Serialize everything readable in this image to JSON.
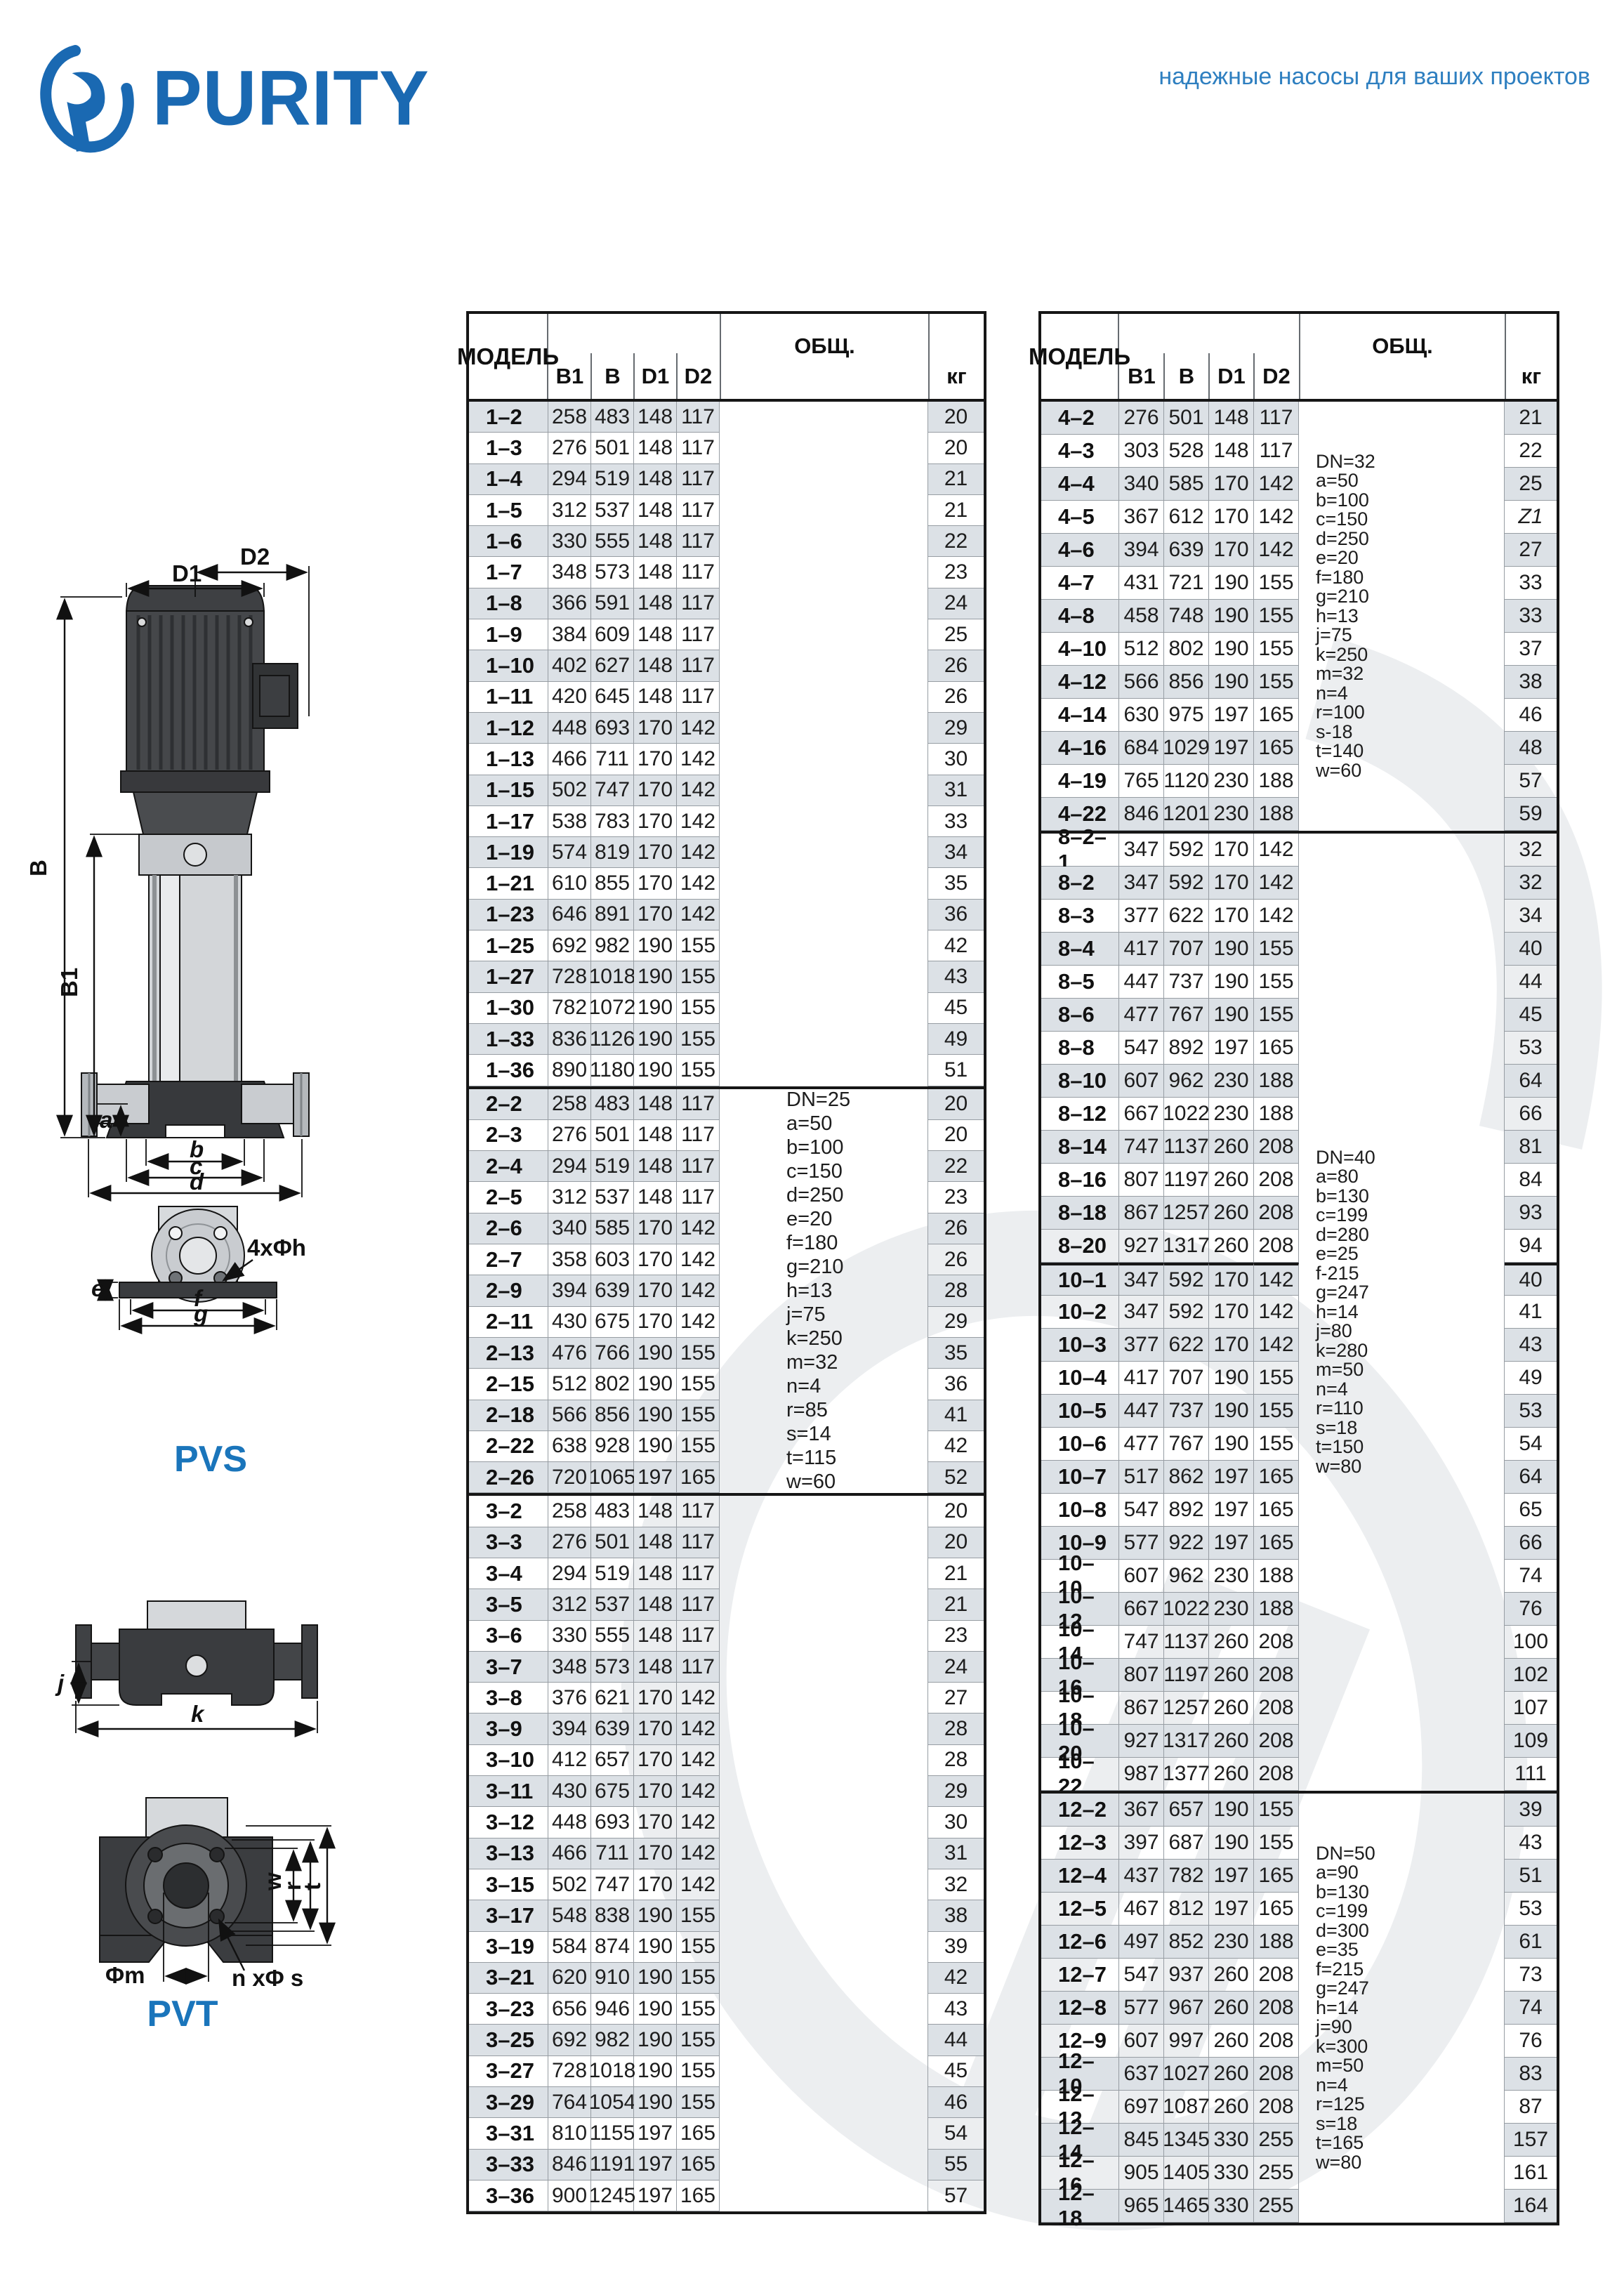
{
  "header": {
    "brand": "PURITY",
    "tagline": "надежные насосы для ваших проектов",
    "brand_color": "#1a69b2",
    "tagline_color": "#2e7fc0"
  },
  "diagrams": {
    "pvs_title": "PVS",
    "pvt_title": "PVT",
    "pvs_dims": [
      "D2",
      "D1",
      "B",
      "B1",
      "a",
      "b",
      "c",
      "d",
      "e",
      "f",
      "g",
      "4xΦh"
    ],
    "jk_dims": [
      "j",
      "k"
    ],
    "pvt_dims": [
      "Φm",
      "n xΦ s",
      "w",
      "r",
      "t"
    ],
    "title_color": "#1a75bb"
  },
  "tables": [
    {
      "id": "table-left",
      "headers": {
        "model": "МОДЕЛЬ",
        "b1": "B1",
        "b": "B",
        "d1": "D1",
        "d2": "D2",
        "obsh": "ОБЩ.",
        "kg": "кг"
      },
      "sections": [
        {
          "notes": [],
          "rows": [
            [
              "1–2",
              258,
              483,
              148,
              117,
              20
            ],
            [
              "1–3",
              276,
              501,
              148,
              117,
              20
            ],
            [
              "1–4",
              294,
              519,
              148,
              117,
              21
            ],
            [
              "1–5",
              312,
              537,
              148,
              117,
              21
            ],
            [
              "1–6",
              330,
              555,
              148,
              117,
              22
            ],
            [
              "1–7",
              348,
              573,
              148,
              117,
              23
            ],
            [
              "1–8",
              366,
              591,
              148,
              117,
              24
            ],
            [
              "1–9",
              384,
              609,
              148,
              117,
              25
            ],
            [
              "1–10",
              402,
              627,
              148,
              117,
              26
            ],
            [
              "1–11",
              420,
              645,
              148,
              117,
              26
            ],
            [
              "1–12",
              448,
              693,
              170,
              142,
              29
            ],
            [
              "1–13",
              466,
              711,
              170,
              142,
              30
            ],
            [
              "1–15",
              502,
              747,
              170,
              142,
              31
            ],
            [
              "1–17",
              538,
              783,
              170,
              142,
              33
            ],
            [
              "1–19",
              574,
              819,
              170,
              142,
              34
            ],
            [
              "1–21",
              610,
              855,
              170,
              142,
              35
            ],
            [
              "1–23",
              646,
              891,
              170,
              142,
              36
            ],
            [
              "1–25",
              692,
              982,
              190,
              155,
              42
            ],
            [
              "1–27",
              728,
              1018,
              190,
              155,
              43
            ],
            [
              "1–30",
              782,
              1072,
              190,
              155,
              45
            ],
            [
              "1–33",
              836,
              1126,
              190,
              155,
              49
            ],
            [
              "1–36",
              890,
              1180,
              190,
              155,
              51
            ]
          ]
        },
        {
          "notes": [
            "DN=25",
            "a=50",
            "b=100",
            "c=150",
            "d=250",
            "e=20",
            "f=180",
            "g=210",
            "h=13",
            "j=75",
            "k=250",
            "m=32",
            "n=4",
            "r=85",
            "s=14",
            "t=115",
            "w=60"
          ],
          "rows": [
            [
              "2–2",
              258,
              483,
              148,
              117,
              20
            ],
            [
              "2–3",
              276,
              501,
              148,
              117,
              20
            ],
            [
              "2–4",
              294,
              519,
              148,
              117,
              22
            ],
            [
              "2–5",
              312,
              537,
              148,
              117,
              23
            ],
            [
              "2–6",
              340,
              585,
              170,
              142,
              26
            ],
            [
              "2–7",
              358,
              603,
              170,
              142,
              26
            ],
            [
              "2–9",
              394,
              639,
              170,
              142,
              28
            ],
            [
              "2–11",
              430,
              675,
              170,
              142,
              29
            ],
            [
              "2–13",
              476,
              766,
              190,
              155,
              35
            ],
            [
              "2–15",
              512,
              802,
              190,
              155,
              36
            ],
            [
              "2–18",
              566,
              856,
              190,
              155,
              41
            ],
            [
              "2–22",
              638,
              928,
              190,
              155,
              42
            ],
            [
              "2–26",
              720,
              1065,
              197,
              165,
              52
            ]
          ]
        },
        {
          "notes": [],
          "rows": [
            [
              "3–2",
              258,
              483,
              148,
              117,
              20
            ],
            [
              "3–3",
              276,
              501,
              148,
              117,
              20
            ],
            [
              "3–4",
              294,
              519,
              148,
              117,
              21
            ],
            [
              "3–5",
              312,
              537,
              148,
              117,
              21
            ],
            [
              "3–6",
              330,
              555,
              148,
              117,
              23
            ],
            [
              "3–7",
              348,
              573,
              148,
              117,
              24
            ],
            [
              "3–8",
              376,
              621,
              170,
              142,
              27
            ],
            [
              "3–9",
              394,
              639,
              170,
              142,
              28
            ],
            [
              "3–10",
              412,
              657,
              170,
              142,
              28
            ],
            [
              "3–11",
              430,
              675,
              170,
              142,
              29
            ],
            [
              "3–12",
              448,
              693,
              170,
              142,
              30
            ],
            [
              "3–13",
              466,
              711,
              170,
              142,
              31
            ],
            [
              "3–15",
              502,
              747,
              170,
              142,
              32
            ],
            [
              "3–17",
              548,
              838,
              190,
              155,
              38
            ],
            [
              "3–19",
              584,
              874,
              190,
              155,
              39
            ],
            [
              "3–21",
              620,
              910,
              190,
              155,
              42
            ],
            [
              "3–23",
              656,
              946,
              190,
              155,
              43
            ],
            [
              "3–25",
              692,
              982,
              190,
              155,
              44
            ],
            [
              "3–27",
              728,
              1018,
              190,
              155,
              45
            ],
            [
              "3–29",
              764,
              1054,
              190,
              155,
              46
            ],
            [
              "3–31",
              810,
              1155,
              197,
              165,
              54
            ],
            [
              "3–33",
              846,
              1191,
              197,
              165,
              55
            ],
            [
              "3–36",
              900,
              1245,
              197,
              165,
              57
            ]
          ]
        }
      ]
    },
    {
      "id": "table-right",
      "headers": {
        "model": "МОДЕЛЬ",
        "b1": "B1",
        "b": "B",
        "d1": "D1",
        "d2": "D2",
        "obsh": "ОБЩ.",
        "kg": "кг"
      },
      "sections": [
        {
          "notes": [
            "DN=32",
            "a=50",
            "b=100",
            "c=150",
            "d=250",
            "e=20",
            "f=180",
            "g=210",
            "h=13",
            "j=75",
            "k=250",
            "m=32",
            "n=4",
            "r=100",
            "s-18",
            "t=140",
            "w=60"
          ],
          "rows": [
            [
              "4–2",
              276,
              501,
              148,
              117,
              21
            ],
            [
              "4–3",
              303,
              528,
              148,
              117,
              22
            ],
            [
              "4–4",
              340,
              585,
              170,
              142,
              25
            ],
            [
              "4–5",
              367,
              612,
              170,
              142,
              "Z1"
            ],
            [
              "4–6",
              394,
              639,
              170,
              142,
              27
            ],
            [
              "4–7",
              431,
              721,
              190,
              155,
              33
            ],
            [
              "4–8",
              458,
              748,
              190,
              155,
              33
            ],
            [
              "4–10",
              512,
              802,
              190,
              155,
              37
            ],
            [
              "4–12",
              566,
              856,
              190,
              155,
              38
            ],
            [
              "4–14",
              630,
              975,
              197,
              165,
              46
            ],
            [
              "4–16",
              684,
              1029,
              197,
              165,
              48
            ],
            [
              "4–19",
              765,
              1120,
              230,
              188,
              57
            ],
            [
              "4–22",
              846,
              1201,
              230,
              188,
              59
            ]
          ]
        },
        {
          "notes": [
            "DN=40",
            "a=80",
            "b=130",
            "c=199",
            "d=280",
            "e=25",
            "f-215",
            "g=247",
            "h=14",
            "j=80",
            "k=280",
            "m=50",
            "n=4",
            "r=110",
            "s=18",
            "t=150",
            "w=80"
          ],
          "divider_before": "10–1",
          "rows": [
            [
              "8–2–1",
              347,
              592,
              170,
              142,
              32
            ],
            [
              "8–2",
              347,
              592,
              170,
              142,
              32
            ],
            [
              "8–3",
              377,
              622,
              170,
              142,
              34
            ],
            [
              "8–4",
              417,
              707,
              190,
              155,
              40
            ],
            [
              "8–5",
              447,
              737,
              190,
              155,
              44
            ],
            [
              "8–6",
              477,
              767,
              190,
              155,
              45
            ],
            [
              "8–8",
              547,
              892,
              197,
              165,
              53
            ],
            [
              "8–10",
              607,
              962,
              230,
              188,
              64
            ],
            [
              "8–12",
              667,
              1022,
              230,
              188,
              66
            ],
            [
              "8–14",
              747,
              1137,
              260,
              208,
              81
            ],
            [
              "8–16",
              807,
              1197,
              260,
              208,
              84
            ],
            [
              "8–18",
              867,
              1257,
              260,
              208,
              93
            ],
            [
              "8–20",
              927,
              1317,
              260,
              208,
              94
            ],
            [
              "10–1",
              347,
              592,
              170,
              142,
              40
            ],
            [
              "10–2",
              347,
              592,
              170,
              142,
              41
            ],
            [
              "10–3",
              377,
              622,
              170,
              142,
              43
            ],
            [
              "10–4",
              417,
              707,
              190,
              155,
              49
            ],
            [
              "10–5",
              447,
              737,
              190,
              155,
              53
            ],
            [
              "10–6",
              477,
              767,
              190,
              155,
              54
            ],
            [
              "10–7",
              517,
              862,
              197,
              165,
              64
            ],
            [
              "10–8",
              547,
              892,
              197,
              165,
              65
            ],
            [
              "10–9",
              577,
              922,
              197,
              165,
              66
            ],
            [
              "10–10",
              607,
              962,
              230,
              188,
              74
            ],
            [
              "10–12",
              667,
              1022,
              230,
              188,
              76
            ],
            [
              "10–14",
              747,
              1137,
              260,
              208,
              100
            ],
            [
              "10–16",
              807,
              1197,
              260,
              208,
              102
            ],
            [
              "10–18",
              867,
              1257,
              260,
              208,
              107
            ],
            [
              "10–20",
              927,
              1317,
              260,
              208,
              109
            ],
            [
              "10–22",
              987,
              1377,
              260,
              208,
              111
            ]
          ]
        },
        {
          "notes": [
            "DN=50",
            "a=90",
            "b=130",
            "c=199",
            "d=300",
            "e=35",
            "f=215",
            "g=247",
            "h=14",
            "j=90",
            "k=300",
            "m=50",
            "n=4",
            "r=125",
            "s=18",
            "t=165",
            "w=80"
          ],
          "rows": [
            [
              "12–2",
              367,
              657,
              190,
              155,
              39
            ],
            [
              "12–3",
              397,
              687,
              190,
              155,
              43
            ],
            [
              "12–4",
              437,
              782,
              197,
              165,
              51
            ],
            [
              "12–5",
              467,
              812,
              197,
              165,
              53
            ],
            [
              "12–6",
              497,
              852,
              230,
              188,
              61
            ],
            [
              "12–7",
              547,
              937,
              260,
              208,
              73
            ],
            [
              "12–8",
              577,
              967,
              260,
              208,
              74
            ],
            [
              "12–9",
              607,
              997,
              260,
              208,
              76
            ],
            [
              "12–10",
              637,
              1027,
              260,
              208,
              83
            ],
            [
              "12–12",
              697,
              1087,
              260,
              208,
              87
            ],
            [
              "12–14",
              845,
              1345,
              330,
              255,
              157
            ],
            [
              "12–16",
              905,
              1405,
              330,
              255,
              161
            ],
            [
              "12–18",
              965,
              1465,
              330,
              255,
              164
            ]
          ]
        }
      ]
    }
  ]
}
